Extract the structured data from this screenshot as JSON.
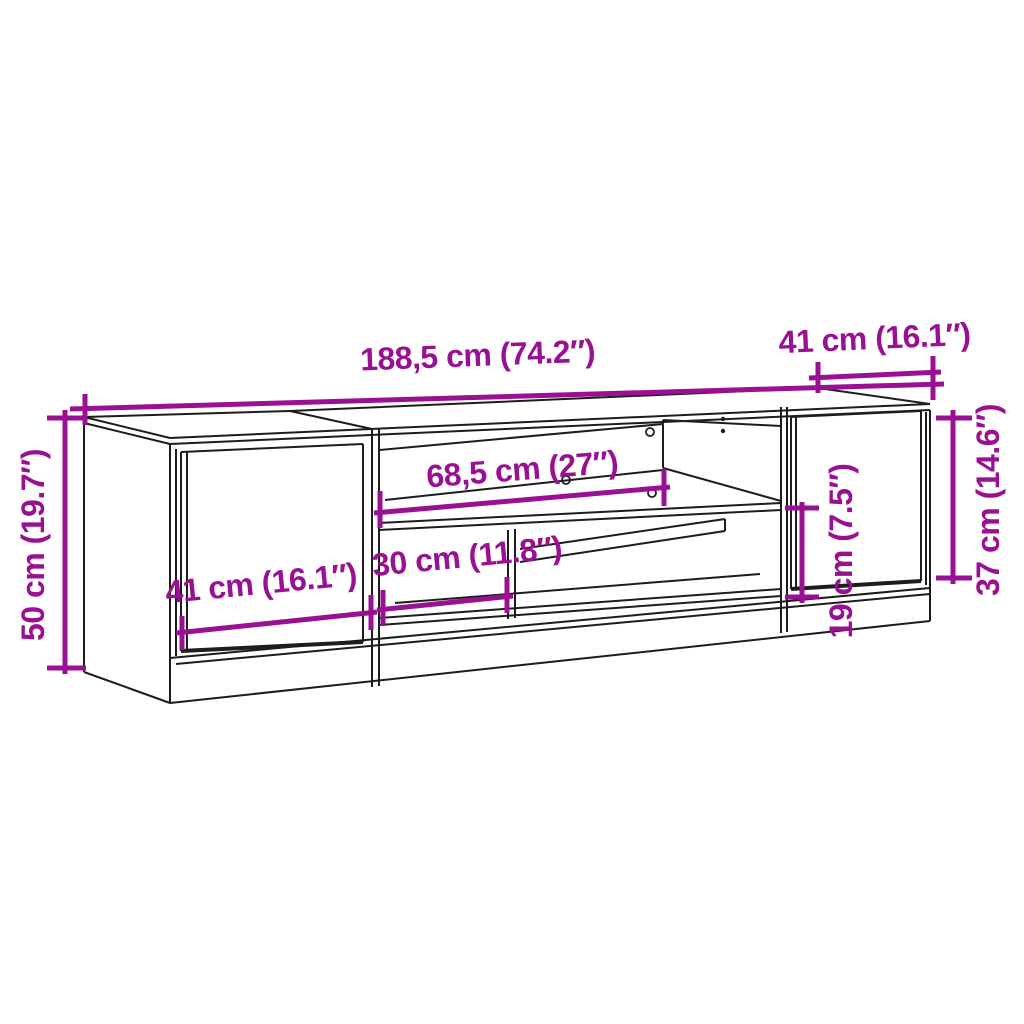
{
  "diagram": {
    "description": "TV stand cabinet technical dimension drawing",
    "background_color": "#ffffff",
    "accent_color": "#9a1092",
    "line_color": "#1d1d1b",
    "dimensions": {
      "overall_width": "188,5 cm (74.2″)",
      "depth": "41 cm (16.1″)",
      "overall_height": "50 cm (19.7″)",
      "right_door_height": "37 cm (14.6″)",
      "upper_shelf_width": "68,5 cm (27″)",
      "left_door_width": "41 cm (16.1″)",
      "lower_compartment_width": "30 cm (11.8″)",
      "lower_compartment_height": "19 cm (7.5″)"
    }
  }
}
